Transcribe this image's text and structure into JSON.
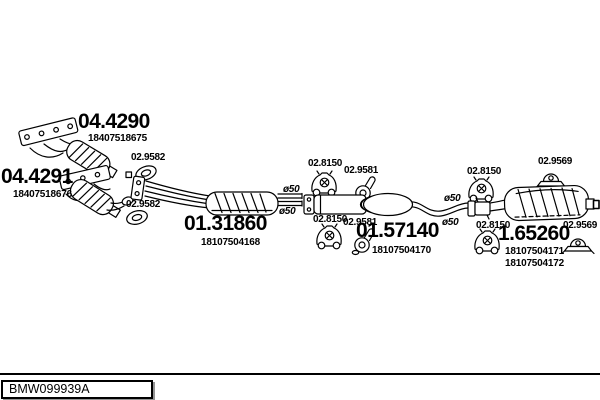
{
  "diagram": {
    "parts": [
      {
        "code": "04.4290",
        "oem": [
          "18407518675"
        ]
      },
      {
        "code": "04.4291",
        "oem": [
          "18407518676"
        ]
      },
      {
        "code": "01.31860",
        "oem": [
          "18107504168"
        ]
      },
      {
        "code": "01.57140",
        "oem": [
          "18107504170"
        ]
      },
      {
        "code": "1.65260",
        "oem": [
          "18107504171",
          "18107504172"
        ]
      }
    ],
    "fittings": {
      "gasket_code": "02.9582",
      "hanger_code": "02.8150",
      "center_mount_code": "02.9581",
      "rear_mount_code": "02.9569"
    },
    "pipe_diameter_label": "ø50",
    "colors": {
      "line": "#000000",
      "background": "#ffffff",
      "footer_shadow": "#949494"
    }
  },
  "footer": {
    "drawing_number": "BMW099939A"
  }
}
